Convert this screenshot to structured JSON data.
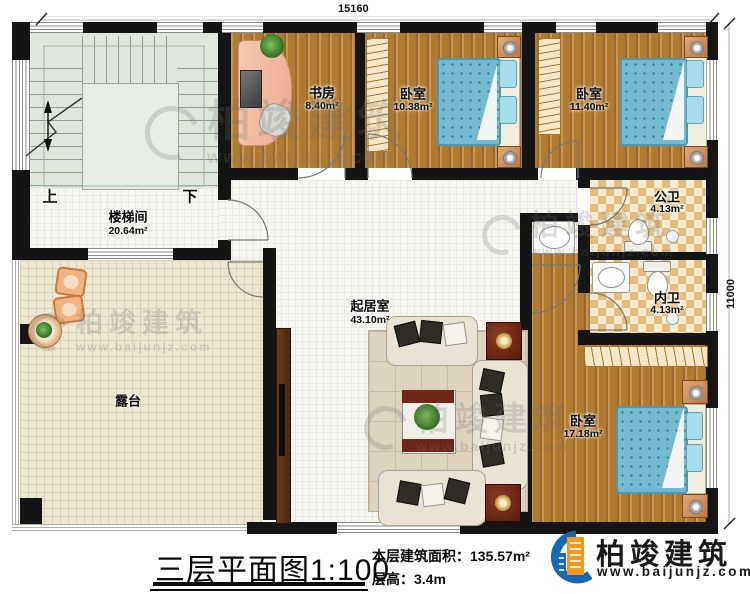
{
  "dims": {
    "top": "15160",
    "right": "11000"
  },
  "stairs": {
    "up": "上",
    "down": "下"
  },
  "rooms": [
    {
      "name": "楼梯间",
      "area": "20.64m²"
    },
    {
      "name": "书房",
      "area": "8.40m²"
    },
    {
      "name": "卧室",
      "area": "10.38m²"
    },
    {
      "name": "卧室",
      "area": "11.40m²"
    },
    {
      "name": "公卫",
      "area": "4.13m²"
    },
    {
      "name": "内卫",
      "area": "4.13m²"
    },
    {
      "name": "起居室",
      "area": "43.10m²"
    },
    {
      "name": "露台",
      "area": ""
    },
    {
      "name": "卧室",
      "area": "17.18m²"
    }
  ],
  "title_block": {
    "plan_title": "三层平面图1:100",
    "area_label": "本层建筑面积：",
    "area_value": "135.57m²",
    "height_label": "层高：",
    "height_value": "3.4m"
  },
  "brand": {
    "name": "柏竣建筑",
    "site": "www.baijunjz.com"
  },
  "colors": {
    "wall": "#151515",
    "wood_floor": "#b07a31",
    "bed_blue": "#74bad1",
    "brand_blue": "#1668b3",
    "brand_orange": "#f5991d"
  }
}
